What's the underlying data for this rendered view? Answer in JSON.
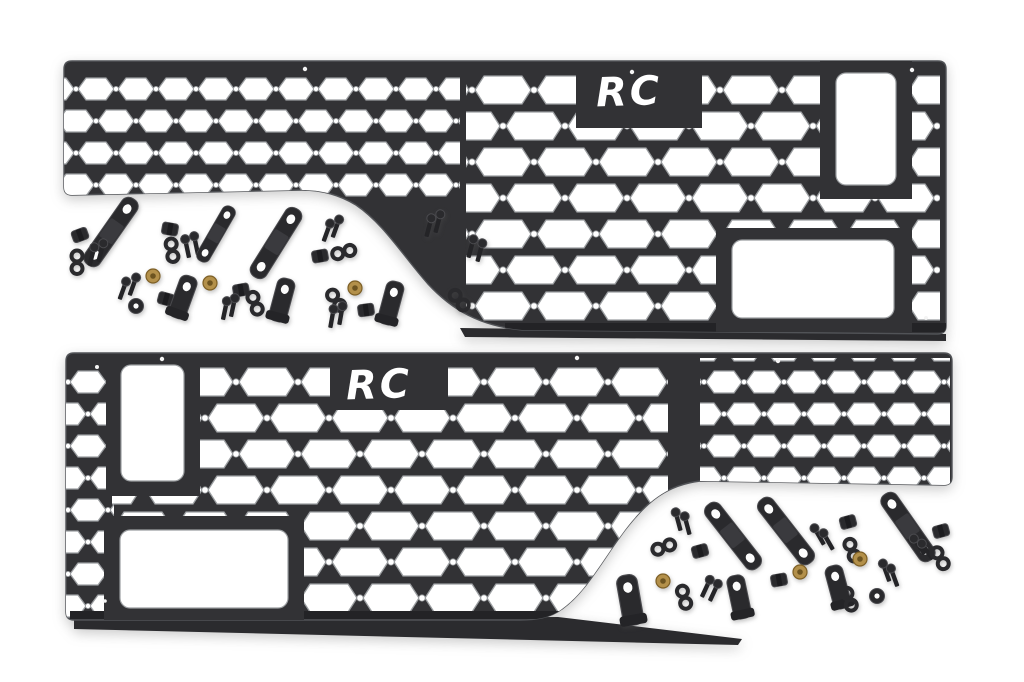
{
  "meta": {
    "type": "product-photo",
    "subject": "Pair of black molle bed storage panels (driver and passenger side) shown with two scattered mounting hardware kits on a white background"
  },
  "brand": {
    "logo_text": "RC",
    "logo_color": "#ffffff"
  },
  "colors": {
    "background": "#ffffff",
    "panel": "#323235",
    "panel_edge": "#515357",
    "panel_lip": "#232326",
    "flange": "#2b2b2e",
    "hardware": "#2a2a2d",
    "hardware_edge": "#4a4a4e",
    "brass_nut": "#b3904a",
    "brass_center": "#6d5420",
    "hole_rim": "#9b9ea1"
  },
  "panels": [
    {
      "id": "top",
      "logo_text": "RC"
    },
    {
      "id": "bottom",
      "logo_text": "RC"
    }
  ],
  "hardware": {
    "kits": [
      {
        "name": "hardware-kit-upper-left",
        "container": "hw-kit-a",
        "items": [
          [
            "block",
            80,
            235,
            -20
          ],
          [
            "strap",
            111,
            232,
            35
          ],
          [
            "washer8",
            77,
            262,
            0
          ],
          [
            "bolt",
            92,
            256,
            15
          ],
          [
            "bolt",
            101,
            252,
            15
          ],
          [
            "block",
            170,
            229,
            10
          ],
          [
            "washer8",
            172,
            250,
            -8
          ],
          [
            "bolt",
            187,
            248,
            -12
          ],
          [
            "bolt",
            196,
            245,
            -12
          ],
          [
            "strap",
            216,
            234,
            30,
            0.78
          ],
          [
            "strap",
            276,
            243,
            32
          ],
          [
            "bolt",
            123,
            290,
            20
          ],
          [
            "bolt",
            133,
            286,
            20
          ],
          [
            "roundwasher",
            136,
            306,
            0
          ],
          [
            "brass",
            153,
            276,
            0
          ],
          [
            "block",
            166,
            299,
            15
          ],
          [
            "lbracket",
            183,
            297,
            20
          ],
          [
            "brass",
            210,
            283,
            0
          ],
          [
            "block",
            241,
            290,
            -10
          ],
          [
            "bolt",
            225,
            310,
            12
          ],
          [
            "bolt",
            233,
            307,
            12
          ],
          [
            "washer8",
            255,
            303,
            -20
          ],
          [
            "lbracket",
            282,
            300,
            15
          ],
          [
            "bolt",
            327,
            232,
            20
          ],
          [
            "bolt",
            336,
            228,
            20
          ],
          [
            "block",
            320,
            256,
            -10
          ],
          [
            "washer8",
            344,
            252,
            75
          ],
          [
            "washer8",
            336,
            300,
            -35
          ],
          [
            "bolt",
            332,
            318,
            10
          ],
          [
            "bolt",
            341,
            315,
            10
          ],
          [
            "brass",
            355,
            288,
            0
          ],
          [
            "block",
            366,
            310,
            -8
          ],
          [
            "lbracket",
            391,
            303,
            15
          ],
          [
            "bolt",
            429,
            227,
            15
          ],
          [
            "bolt",
            438,
            223,
            15
          ],
          [
            "bolt",
            471,
            248,
            15
          ],
          [
            "bolt",
            480,
            252,
            15
          ],
          [
            "washer8",
            459,
            300,
            -40
          ]
        ]
      },
      {
        "name": "hardware-kit-lower-right",
        "container": "hw-kit-b",
        "items": [
          [
            "bolt",
            678,
            521,
            -15
          ],
          [
            "bolt",
            687,
            525,
            -15
          ],
          [
            "washer8",
            664,
            547,
            70
          ],
          [
            "block",
            700,
            551,
            -15
          ],
          [
            "strap",
            733,
            536,
            -38
          ],
          [
            "strap",
            786,
            531,
            -38
          ],
          [
            "bolt",
            819,
            536,
            -30
          ],
          [
            "bolt",
            828,
            541,
            -30
          ],
          [
            "block",
            848,
            522,
            -15
          ],
          [
            "washer8",
            852,
            550,
            -20
          ],
          [
            "strap",
            908,
            527,
            -35
          ],
          [
            "block",
            941,
            531,
            -15
          ],
          [
            "bolt",
            919,
            546,
            -35
          ],
          [
            "bolt",
            927,
            551,
            -35
          ],
          [
            "washer8",
            940,
            558,
            -30
          ],
          [
            "lbracket",
            630,
            600,
            -10,
            1.15
          ],
          [
            "brass",
            663,
            581,
            0
          ],
          [
            "washer8",
            684,
            597,
            -15
          ],
          [
            "bolt",
            706,
            588,
            25
          ],
          [
            "bolt",
            714,
            592,
            25
          ],
          [
            "lbracket",
            739,
            597,
            -12
          ],
          [
            "block",
            779,
            580,
            -10
          ],
          [
            "brass",
            800,
            572,
            0
          ],
          [
            "lbracket",
            838,
            587,
            -15
          ],
          [
            "washer8",
            849,
            599,
            -20
          ],
          [
            "roundwasher",
            877,
            596,
            0
          ],
          [
            "bolt",
            886,
            572,
            -20
          ],
          [
            "bolt",
            894,
            577,
            -20
          ],
          [
            "brass",
            860,
            559,
            0
          ]
        ]
      }
    ]
  }
}
